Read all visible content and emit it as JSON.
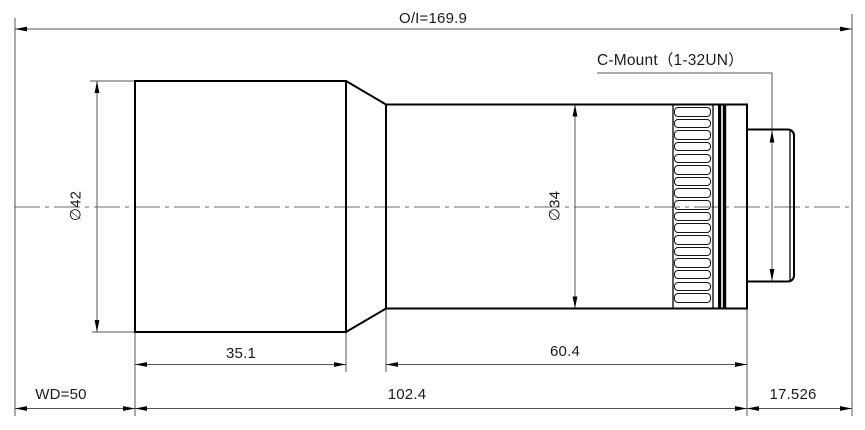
{
  "drawing": {
    "dimensions": {
      "object_to_image": "O/I=169.9",
      "mount": "C-Mount（1-32UN）",
      "front_diameter": "∅42",
      "mid_diameter": "∅34",
      "front_length": "35.1",
      "mid_length": "60.4",
      "working_distance": "WD=50",
      "body_length": "102.4",
      "flange_distance": "17.526"
    },
    "colors": {
      "outline": "#000000",
      "dimension_line": "#555555",
      "centerline": "#8a8a8a",
      "text": "#1b1b1b"
    }
  }
}
